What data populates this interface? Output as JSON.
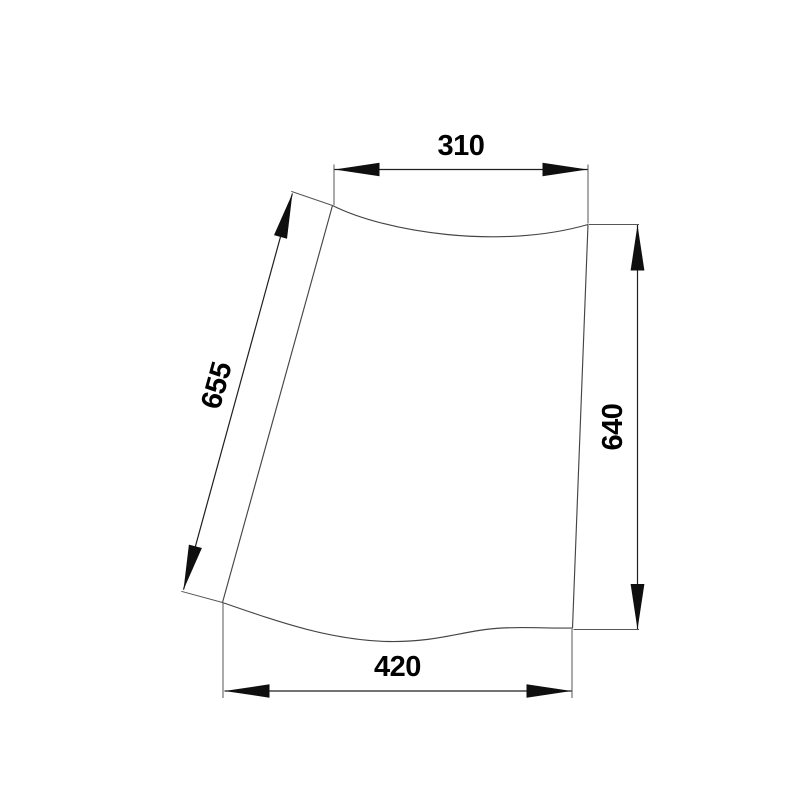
{
  "canvas": {
    "background": "#ffffff",
    "outline_color": "#454545",
    "dimension_line_color": "#1f1f1f",
    "text_color": "#000000"
  },
  "dimensions": {
    "top_width": "310",
    "left_edge_length": "655",
    "right_height": "640",
    "bottom_width": "420"
  }
}
